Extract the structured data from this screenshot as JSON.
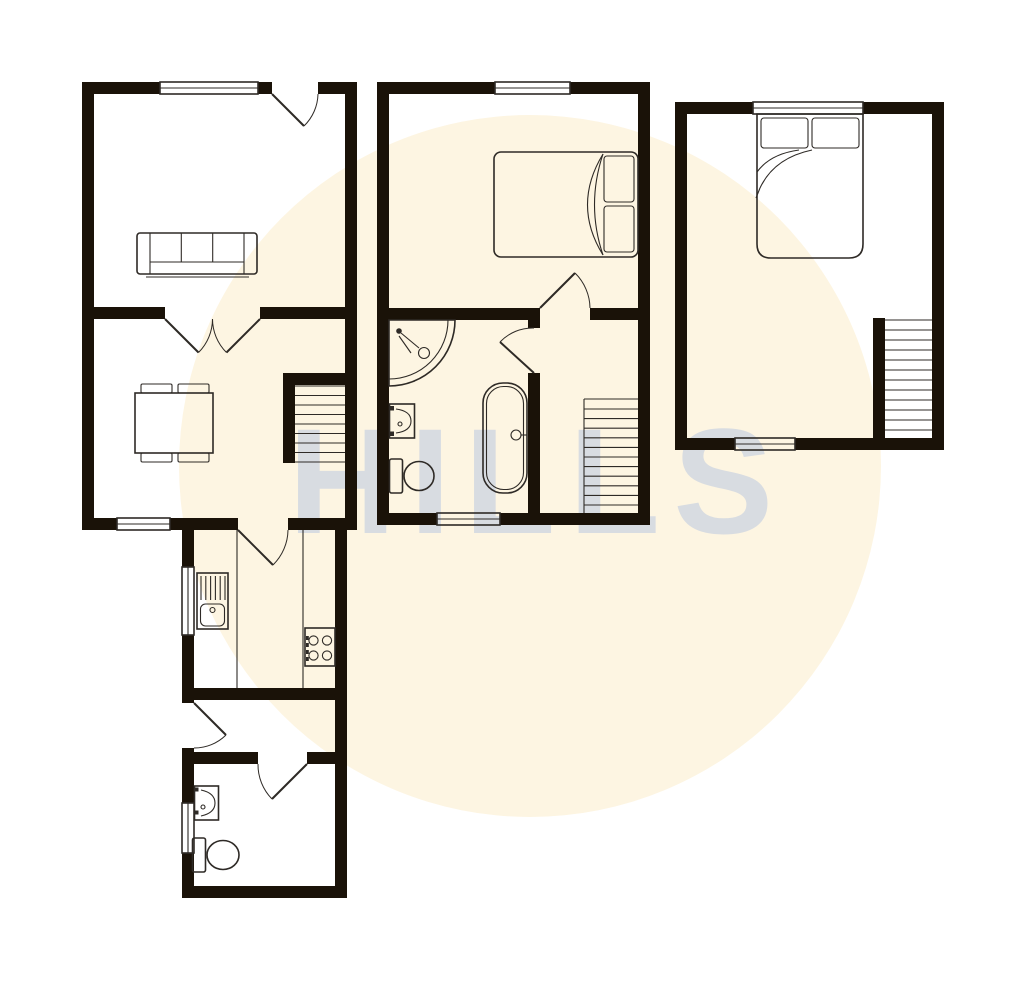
{
  "watermark": {
    "text": "HILLS"
  },
  "colors": {
    "page_bg": "#ffffff",
    "circle_fill": "#fdf5e2",
    "wall": "#1a1208",
    "line": "#2e2a26",
    "watermark_fill": "#c2cde0"
  },
  "floor_plan": {
    "description": "three-section property floor plan, no text labels on plan",
    "units": [
      {
        "name": "left-unit",
        "rooms": [
          "living-room",
          "dining-room",
          "kitchen",
          "hallway",
          "wc"
        ],
        "fixtures": [
          "sofa",
          "dining-table-with-chairs",
          "staircase",
          "kitchen-sink-drainer",
          "hob",
          "hand-basin",
          "toilet"
        ],
        "windows": 4,
        "door-swings": 6
      },
      {
        "name": "middle-unit",
        "rooms": [
          "bedroom",
          "bathroom",
          "landing"
        ],
        "fixtures": [
          "double-bed",
          "corner-shower",
          "hand-basin",
          "toilet",
          "bathtub",
          "staircase"
        ],
        "windows": 2,
        "door-swings": 2
      },
      {
        "name": "right-unit",
        "rooms": [
          "bedroom"
        ],
        "fixtures": [
          "double-bed",
          "staircase"
        ],
        "windows": 2,
        "door-swings": 0
      }
    ]
  }
}
